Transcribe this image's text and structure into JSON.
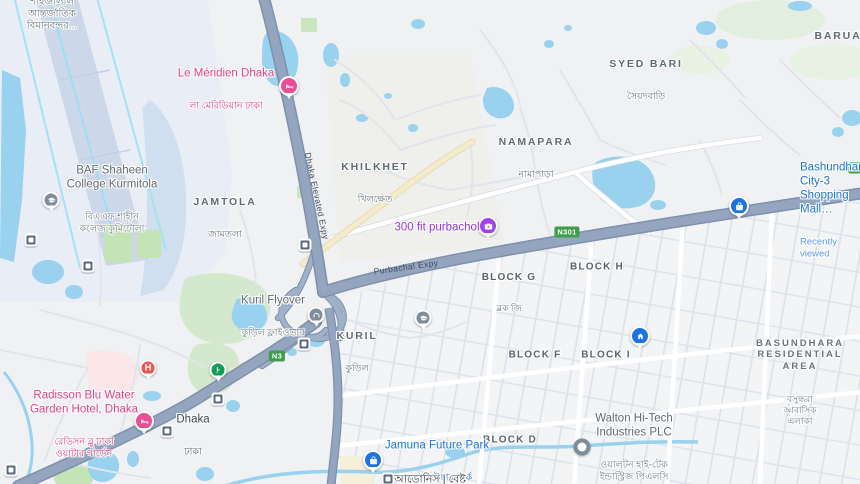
{
  "areas": {
    "airport": {
      "bn": "শাহজালাল\nআন্তর্জাতিক\nবিমানবন্দর..."
    },
    "jamtola": {
      "en": "JAMTOLA",
      "bn": "জামতলা"
    },
    "khilkhet": {
      "en": "KHILKHET",
      "bn": "খিলক্ষেত"
    },
    "namapara": {
      "en": "NAMAPARA",
      "bn": "নামাপাড়া"
    },
    "syed_bari": {
      "en": "SYED BARI",
      "bn": "সৈয়দবাড়ি"
    },
    "barua": {
      "en": "BARUA"
    },
    "kuril": {
      "en": "KURIL",
      "bn": "কুড়িল"
    },
    "block_g": {
      "en": "BLOCK G",
      "bn": "ব্লক জি"
    },
    "block_h": {
      "en": "BLOCK H"
    },
    "block_f": {
      "en": "BLOCK F"
    },
    "block_i": {
      "en": "BLOCK I"
    },
    "block_d": {
      "en": "BLOCK D"
    },
    "basundhara": {
      "en": "BASUNDHARA\nRESIDENTIAL\nAREA",
      "bn": "বসুন্ধরা\nআবাসিক\nএলাকা"
    },
    "dhaka_station": {
      "en": "Dhaka",
      "bn": "ঢাকা"
    }
  },
  "pois": {
    "le_meridien": {
      "name": "Le Méridien Dhaka",
      "bn": "লা মেরিডিয়ান ঢাকা"
    },
    "baf_college": {
      "name": "BAF Shaheen\nCollege Kurmitola",
      "bn": "বিএএফ শাহীন\nকলেজ কুর্মিটোলা"
    },
    "purbachol_300ft": {
      "name": "300 fit purbachol"
    },
    "bashundhara_mall": {
      "name": "Bashundhara\nCity-3 Shopping Mall…",
      "status": "Recently viewed"
    },
    "kuril_flyover": {
      "name": "Kuril Flyover",
      "bn": "কুড়িল ফ্লাইওভার"
    },
    "radisson": {
      "name": "Radisson Blu Water\nGarden Hotel, Dhaka",
      "bn": "রেডিসন ব্লু ঢাকা\nওয়াটার গার্ডেন"
    },
    "jamuna_future_park": {
      "name": "Jamuna Future Park",
      "bn": "যমুনা ফিউচার পার্ক"
    },
    "adonis": {
      "bn": "আডোনিস | বেষ্ট"
    },
    "walton": {
      "name": "Walton Hi-Tech\nIndustries PLC",
      "bn": "ওয়ালটন হাই-টেক\nইন্ডাস্ট্রিজ পিএলসি"
    },
    "hospital_glyph": "H"
  },
  "roads": {
    "elevated_expy": "Dhaka Elevated Expy",
    "purbachal_expy": "Purbachal Expy",
    "n3": "N3",
    "n301": "N301"
  },
  "colors": {
    "water": "#98d2ef",
    "land": "#f0f1f3",
    "expressway": "#94a5bf",
    "poi_blue": "#1a73e8",
    "poi_pink": "#e83d85",
    "poi_purple": "#9334e6",
    "shield_green": "#3f9d4c",
    "park_green": "#c9e6bd"
  }
}
